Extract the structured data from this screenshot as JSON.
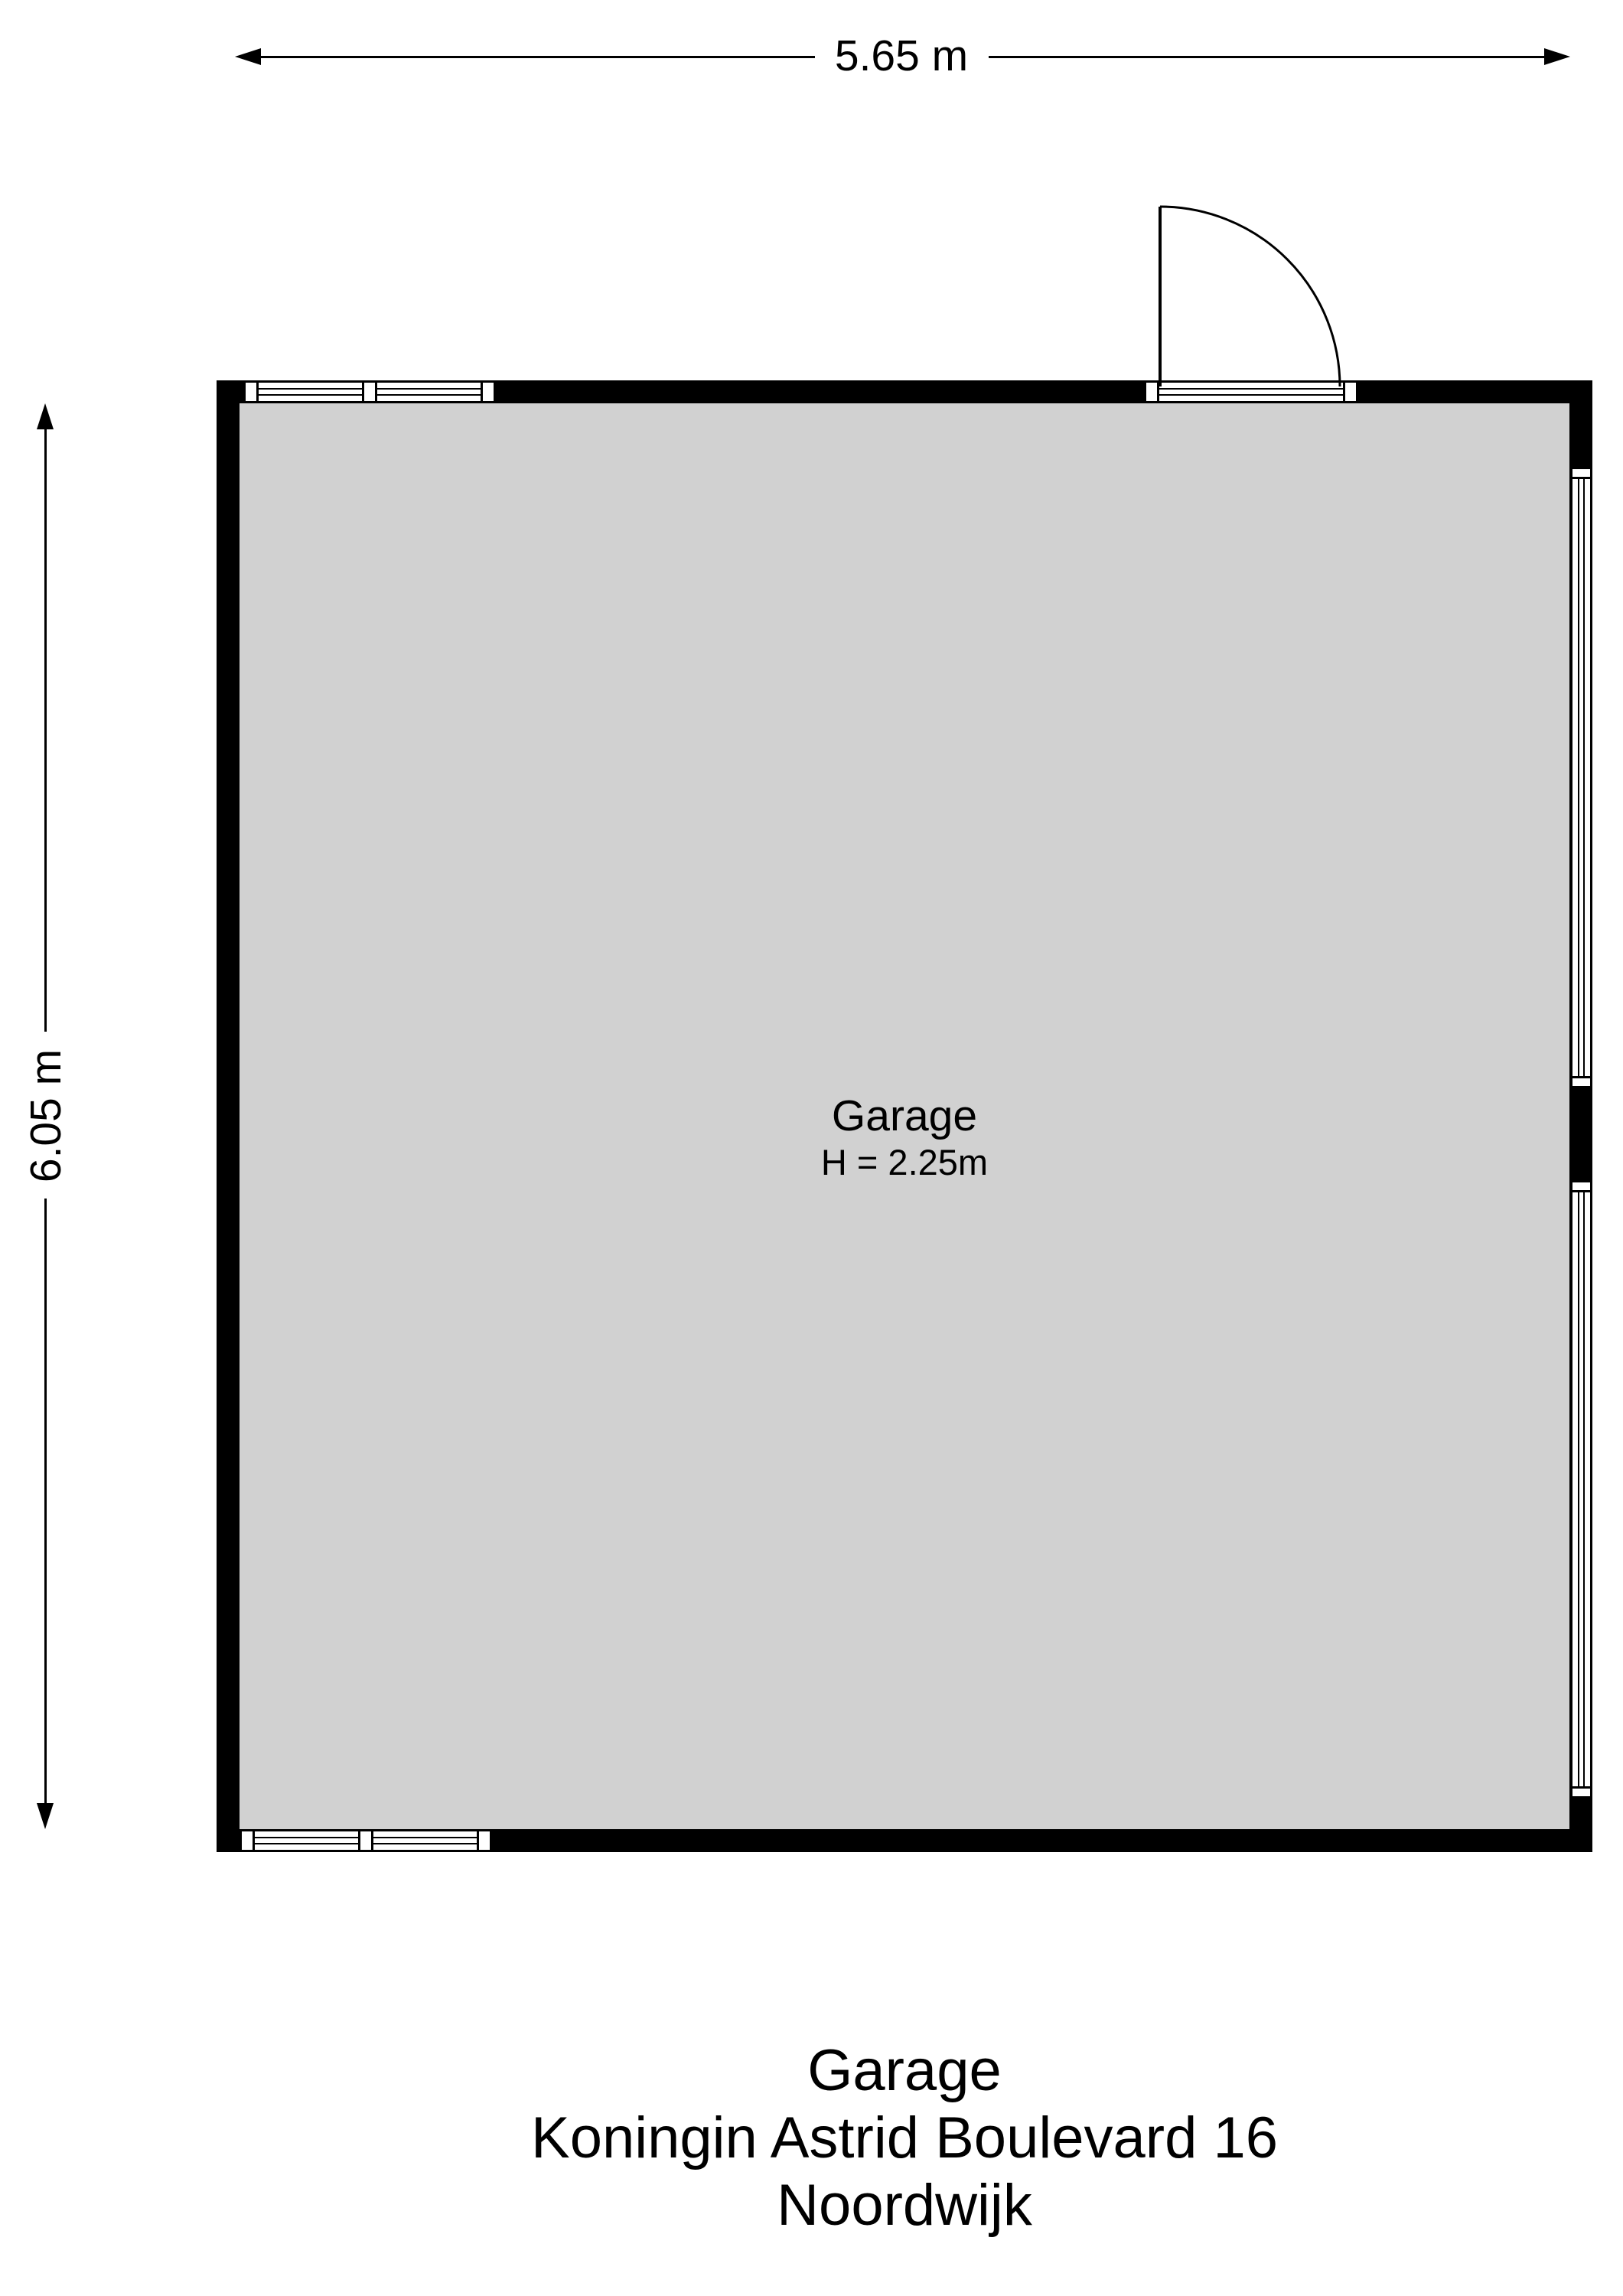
{
  "dimensions": {
    "width_label": "5.65 m",
    "height_label": "6.05 m"
  },
  "room": {
    "name": "Garage",
    "height_note": "H = 2.25m"
  },
  "footer": {
    "line1": "Garage",
    "line2": "Koningin Astrid Boulevard 16",
    "line3": "Noordwijk"
  },
  "colors": {
    "wall": "#000000",
    "floor": "#d1d1d1",
    "background": "#ffffff",
    "line": "#000000"
  }
}
